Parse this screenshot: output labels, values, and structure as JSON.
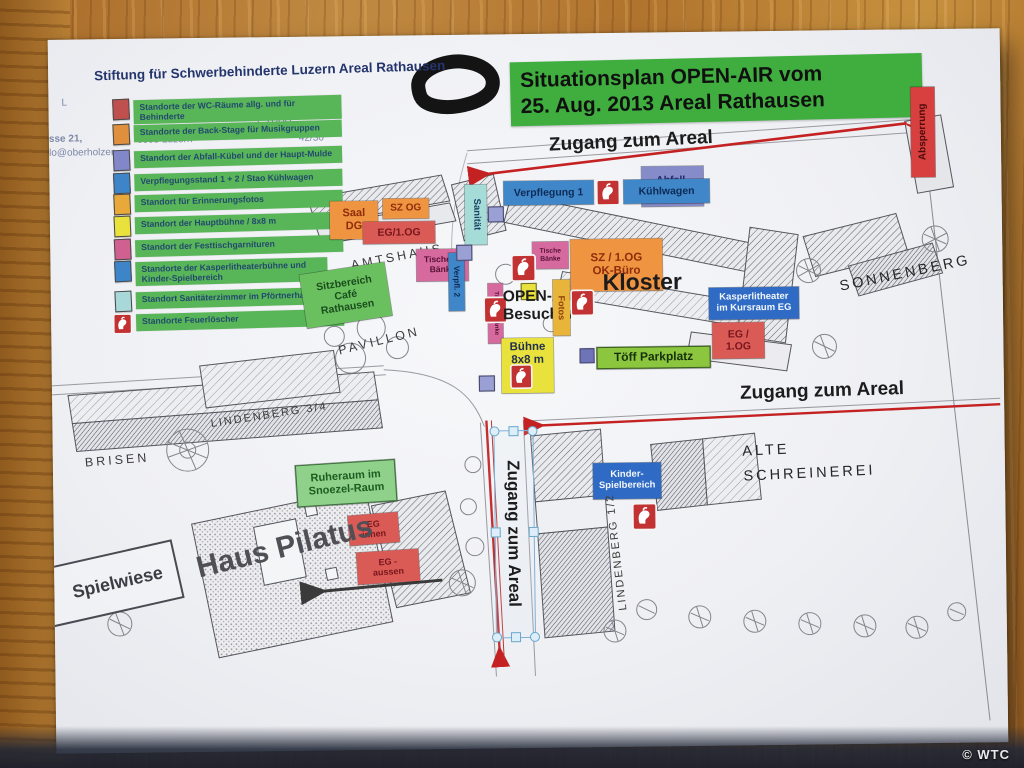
{
  "photo": {
    "credit": "© WTC"
  },
  "colors": {
    "title_green": "#3fae3f",
    "legend_green": "#58b558",
    "arrow_red": "#c42222",
    "paper": "#f1f2f5"
  },
  "document": {
    "letterhead": "Stiftung für Schwerbehinderte Luzern Areal Rathausen",
    "faint": {
      "l_mark": "L",
      "line1": "sse 21,",
      "line2": "lo@oberholzer-",
      "city": "6003 Luzern",
      "scale": "1:1000",
      "number": "42/30"
    },
    "title_line1": "Situationsplan OPEN-AIR vom",
    "title_line2": "25. Aug. 2013 Areal Rathausen"
  },
  "legend": {
    "items": [
      {
        "label": "Standorte der WC-Räume allg. und für Behinderte",
        "color": "#c0504d"
      },
      {
        "label": "Standorte der Back-Stage für Musikgruppen",
        "color": "#e08f3c"
      },
      {
        "label": "Standort der Abfall-Kübel und der Haupt-Mulde",
        "color": "#8287c9"
      },
      {
        "label": "Verpflegungsstand 1 + 2 / Stao Kühlwagen",
        "color": "#3d85c8"
      },
      {
        "label": "Standort für Erinnerungsfotos",
        "color": "#e8a93a"
      },
      {
        "label": "Standort der Hauptbühne / 8x8 m",
        "color": "#e9e13c"
      },
      {
        "label": "Standort der Festtischgarnituren",
        "color": "#d0608f"
      },
      {
        "label": "Standorte der Kasperlitheaterbühne und Kinder-Spielbereich",
        "color": "#3d85c8"
      },
      {
        "label": "Standort Sanitäterzimmer im Pförtnerhaus",
        "color": "#a8d8d8"
      },
      {
        "label": "Standorte Feuerlöscher",
        "color": "#c23232"
      }
    ]
  },
  "map": {
    "labels": {
      "zugang_top": "Zugang zum Areal",
      "zugang_right": "Zugang zum Areal",
      "zugang_vertical": "Zugang zum Areal",
      "absperrung": "Absperrung",
      "kloster": "Kloster",
      "sonnenberg": "SONNENBERG",
      "amtshaus": "AMTSHAUS",
      "pavillon": "PAVILLON",
      "brisen": "BRISEN",
      "lindenberg34": "LINDENBERG 3/4",
      "lindenberg12": "LINDENBERG 1/2",
      "alte_schreinerei": "ALTE\nSCHREINEREI",
      "haus_pilatus": "Haus Pilatus",
      "spielwiese": "Spielwiese",
      "open_air_besucher": "OPEN-Air\nBesucher"
    },
    "boxes": {
      "saal_dg": "Saal\nDG",
      "sz_og": "SZ OG",
      "eg_1og_amtshaus": "EG/1.OG",
      "tische_u_baenke": "Tische u.\nBänke",
      "tische_baenke": "Tische\nBänke",
      "tische_plus_baenke": "Tische + Bänke",
      "verpflegung_1": "Verpflegung 1",
      "kuehlwagen": "Kühlwagen",
      "abfall_mulde": "Abfall-\nMulde",
      "sanitaet": "Sanität",
      "verpfl_2": "Verpfl. 2",
      "fotos": "Fotos",
      "sz_1og_ok_buero": "SZ / 1.OG\nOK-Büro",
      "kasperlitheater": "Kasperlitheater\nim Kursraum EG",
      "eg_1og_kloster": "EG /\n1.OG",
      "toeff_parkplatz": "Töff Parkplatz",
      "buehne": "Bühne\n8x8 m",
      "kinder_spielbereich": "Kinder-\nSpielbereich",
      "ruheraum": "Ruheraum im\nSnoezel-Raum",
      "eg_innen": "EG\ninnen",
      "eg_aussen": "EG -\naussen"
    }
  }
}
